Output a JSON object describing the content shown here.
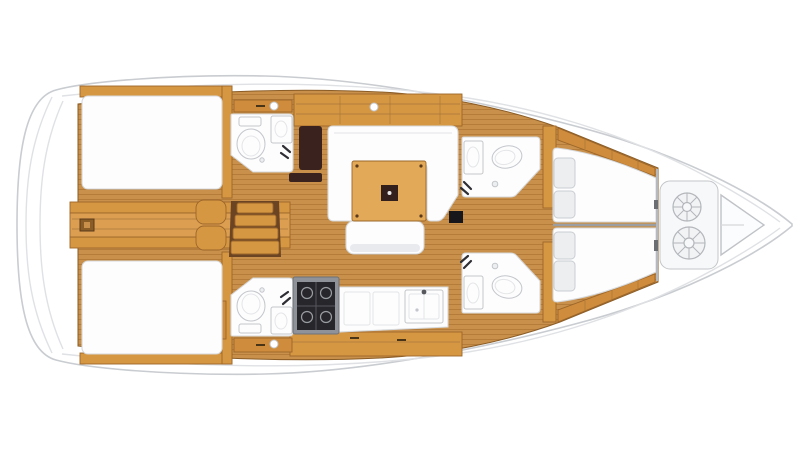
{
  "meta": {
    "title": "Sailboat interior deck plan (overhead view)",
    "view": "top-down yacht floor plan, bow pointing right, stern at left",
    "visible_text": "none"
  },
  "colors": {
    "background": "#ffffff",
    "hull_fill": "#ffffff",
    "hull_stroke": "#c9ccd0",
    "deck_line": "#dfe1e4",
    "teak_base": "#c8904a",
    "teak_stripe": "#a9712f",
    "wood_beam": "#d69743",
    "wood_cabinet": "#cf8c3c",
    "walkway_teak": "#dc9f52",
    "step_shadow": "#6b4423",
    "table_wood": "#e2aa58",
    "table_pad": "#33201c",
    "dark_brown": "#3a231e",
    "black": "#17171b",
    "white_furniture": "#fdfdfe",
    "pillow_fill": "#eceef0",
    "shadow_gray": "#e9eaee",
    "metal_gray": "#8f9399",
    "stove_dark": "#26262b",
    "locker_fill": "#f7f8f9"
  },
  "boat": {
    "orientation": {
      "stern": "left",
      "bow": "right"
    },
    "sections": [
      {
        "id": "swim-platform",
        "label": "stern swim platform / transom"
      },
      {
        "id": "aft-cabin-port",
        "label": "aft double cabin (top)",
        "furniture": [
          "double-berth"
        ]
      },
      {
        "id": "aft-cabin-starboard",
        "label": "aft double cabin (bottom)",
        "furniture": [
          "double-berth"
        ]
      },
      {
        "id": "aft-walkway",
        "label": "centerline walkway between aft cabins"
      },
      {
        "id": "companionway",
        "label": "companionway steps with seat"
      },
      {
        "id": "aft-head-port",
        "label": "aft head (top)",
        "furniture": [
          "toilet",
          "washbasin",
          "shower-fitting"
        ]
      },
      {
        "id": "aft-head-starboard",
        "label": "aft head (bottom)",
        "furniture": [
          "toilet",
          "washbasin",
          "shower-fitting"
        ]
      },
      {
        "id": "nav-seat",
        "label": "dark chart-table seat"
      },
      {
        "id": "saloon",
        "label": "saloon",
        "furniture": [
          "u-shaped-settee",
          "dining-table",
          "bench-settee"
        ]
      },
      {
        "id": "galley",
        "label": "galley (bottom center)",
        "furniture": [
          "stove",
          "counter-lockers",
          "double-sink"
        ]
      },
      {
        "id": "forward-head-port",
        "label": "forward head (top)",
        "furniture": [
          "toilet",
          "washbasin",
          "shower-fitting"
        ]
      },
      {
        "id": "forward-head-starboard",
        "label": "forward head (bottom)",
        "furniture": [
          "toilet",
          "washbasin",
          "shower-fitting"
        ]
      },
      {
        "id": "forward-cabin",
        "label": "forward owner cabin",
        "furniture": [
          "twin-berths",
          "four-pillows"
        ]
      },
      {
        "id": "anchor-locker",
        "label": "bow anchor locker",
        "furniture": [
          "rope-coil",
          "rope-coil",
          "bow-pulpit-triangle"
        ]
      }
    ]
  }
}
